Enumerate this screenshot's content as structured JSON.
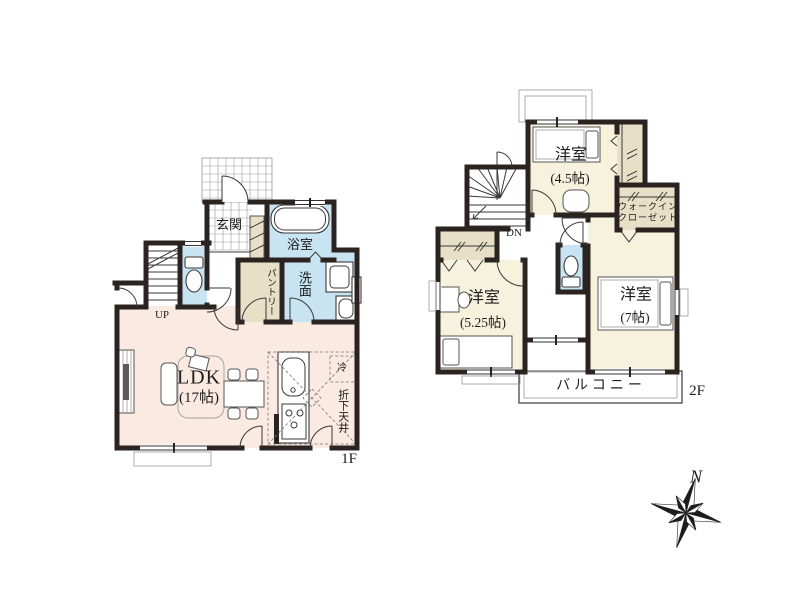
{
  "floor1": {
    "label": "1F",
    "genkan": "玄関",
    "bath": "浴室",
    "washroom": "洗面",
    "pantry": "パントリー",
    "stairs_up": "UP",
    "ldk_name": "LDK",
    "ldk_size": "(17帖)",
    "fridge": "冷",
    "dropped_ceiling": "折下天井",
    "duct_right": "DS",
    "duct_kitchen": "PS"
  },
  "floor2": {
    "label": "2F",
    "bedroom1_name": "洋室",
    "bedroom1_size": "(4.5帖)",
    "bedroom2_name": "洋室",
    "bedroom2_size": "(5.25帖)",
    "bedroom3_name": "洋室",
    "bedroom3_size": "(7帖)",
    "wic_line1": "ウォークイン",
    "wic_line2": "クローゼット",
    "stairs_down": "DN",
    "balcony": "バルコニー"
  },
  "compass": {
    "north": "N"
  },
  "colors": {
    "wall": "#2b2320",
    "floor-ldk": "#faeae1",
    "floor-room": "#f7f2dd",
    "wet": "#c8e3f2",
    "closet": "#e7dfc6"
  }
}
